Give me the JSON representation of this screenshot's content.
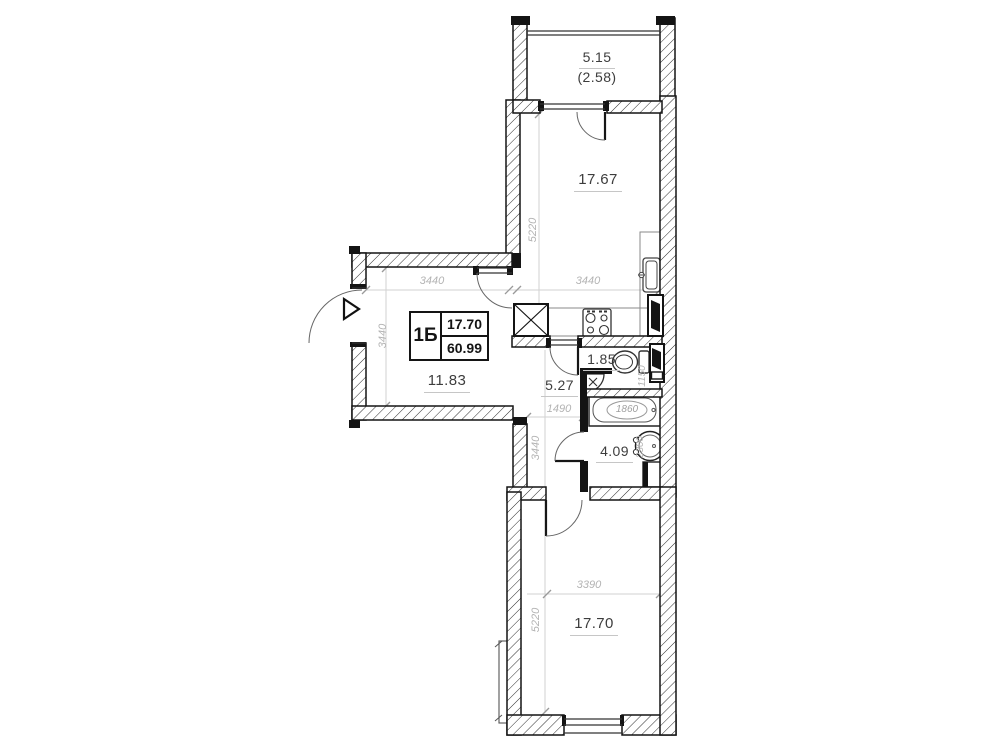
{
  "unit": {
    "type_label": "1Б",
    "living_area": "17.70",
    "total_area": "60.99"
  },
  "rooms": {
    "balcony": {
      "area": "5.15",
      "reduced_area": "(2.58)"
    },
    "kitchen_living": {
      "area": "17.67"
    },
    "hall": {
      "area": "11.83"
    },
    "corridor": {
      "area": "5.27"
    },
    "wc": {
      "area": "1.85"
    },
    "bathroom": {
      "area": "4.09"
    },
    "bedroom": {
      "area": "17.70"
    }
  },
  "dimensions_mm": {
    "kitchen_depth": "5220",
    "kitchen_width": "3440",
    "hall_width": "3440",
    "hall_depth": "3440",
    "corridor_width": "1490",
    "corridor_depth": "3440",
    "wc_depth": "1150",
    "bathroom_depth": "2300",
    "bathtub_length": "1860",
    "bedroom_width": "3390",
    "bedroom_depth": "5220"
  },
  "fixtures": [
    "vent-shaft",
    "stove",
    "kitchen-sink",
    "riser",
    "toilet",
    "corner-washbasin",
    "bathtub",
    "washbasin",
    "cabinet",
    "entrance-arrow"
  ],
  "colors": {
    "wall": "#141414",
    "dim_text": "#b3b3b3",
    "label_text": "#3d3d3d"
  }
}
